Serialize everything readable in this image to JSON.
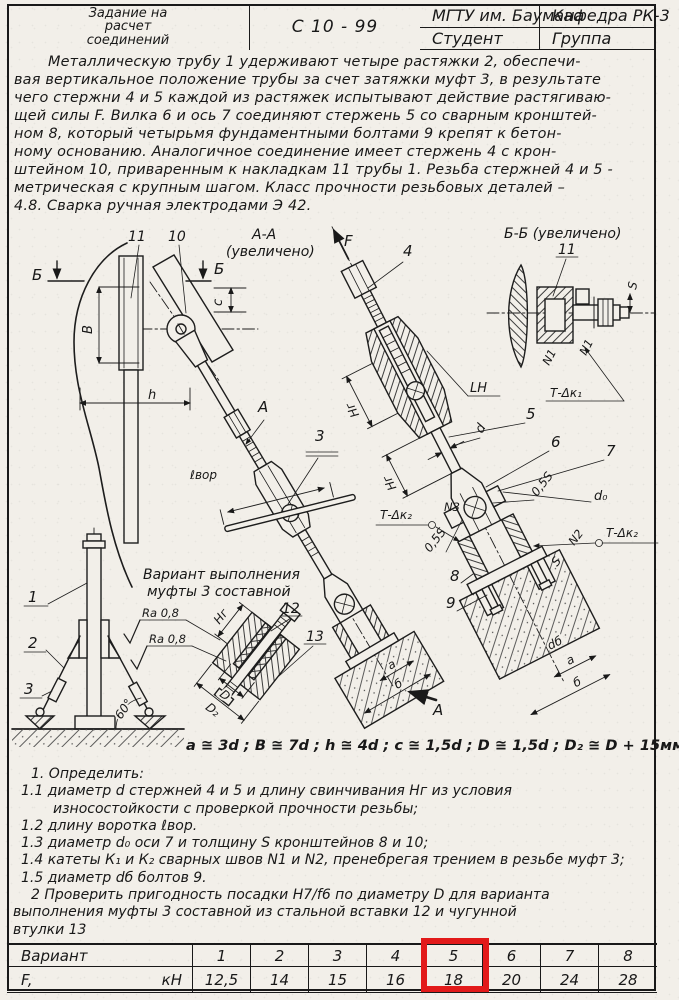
{
  "header": {
    "org": "МГТУ им. Баумана",
    "dept": "Кафедра РК-3",
    "title_line1": "Задание на",
    "title_line2": "расчет",
    "title_line3": "соединений",
    "code": "С 10 - 99",
    "student_label": "Студент",
    "group_label": "Группа"
  },
  "description": {
    "lines": [
      "Металлическую трубу 1 удерживают четыре растяжки 2, обеспечи-",
      "вая вертикальное положение трубы за счет затяжки муфт 3, в результате",
      "чего стержни 4 и 5 каждой из растяжек испытывают действие растягиваю-",
      "щей силы F. Вилка 6 и ось 7 соединяют стержень 5 со сварным кронштей-",
      "ном 8, который четырьмя фундаментными болтами 9 крепят к бетон-",
      "ному основанию. Аналогичное соединение имеет стержень 4 с крон-",
      "штейном 10, приваренным к накладкам 11 трубы 1. Резьба стержней 4 и 5 -",
      "метрическая с крупным шагом. Класс прочности резьбовых деталей –",
      "4.8. Сварка ручная электродами Э 42."
    ]
  },
  "views": {
    "aa_title_1": "А-А",
    "aa_title_2": "(увеличено)",
    "bb_title": "Б-Б (увеличено)",
    "variant_note_1": "Вариант выполнения",
    "variant_note_2": "муфты 3 составной",
    "ra_top": "Ra 0,8",
    "ra_bottom": "Ra 0,8"
  },
  "labels": {
    "f": "F",
    "p1": "1",
    "p2": "2",
    "p3": "3",
    "p3b": "3",
    "p4": "4",
    "p5": "5",
    "p6": "6",
    "p7": "7",
    "p8": "8",
    "p9": "9",
    "p10": "10",
    "p11": "11",
    "p11b": "11",
    "p12": "12",
    "p13": "13",
    "b_left": "Б",
    "b_right": "Б",
    "a_view": "А",
    "a_section": "А",
    "dim_B": "В",
    "dim_h": "h",
    "dim_c": "c",
    "dim_lvor": "ℓвор",
    "hg1": "Нг",
    "hg2": "Нг",
    "hg3": "Нг",
    "dim_d": "d",
    "dim_d0": "d₀",
    "dim_db": "dб",
    "s05a": "0,5S",
    "s05b": "0,5S",
    "dim_S": "S",
    "dim_S2": "S",
    "dim_D": "D",
    "dim_D2": "D₂",
    "a1": "a",
    "b1": "б",
    "a2": "a",
    "b2": "б",
    "lh": "LH",
    "deg60": "60°",
    "n1a": "N1",
    "n1b": "N1",
    "n2": "N2",
    "n3": "N3",
    "tk1": "Т-Δк₁",
    "tk2a": "Т-Δк₂",
    "tk2b": "Т-Δк₂"
  },
  "formula": "a ≅ 3d ;   В ≅ 7d ;   h ≅ 4d ;   c ≅ 1,5d ;   D ≅ 1,5d ;   D₂ ≅ D + 15мм.",
  "tasks": {
    "lines": [
      "1. Определить:",
      "1.1 диаметр d стержней 4 и 5 и длину свинчивания Нг из условия",
      "износостойкости с проверкой прочности резьбы;",
      "1.2 длину воротка ℓвор.",
      "1.3 диаметр d₀ оси 7 и толщину S кронштейнов 8 и 10;",
      "1.4 катеты К₁ и К₂ сварных швов N1 и N2, пренебрегая трением в резьбе муфт 3;",
      "1.5 диаметр dб болтов 9.",
      "2 Проверить пригодность посадки Н7/f6 по диаметру D для варианта",
      "выполнения муфты 3 составной из стальной вставки 12 и чугунной",
      "втулки 13"
    ]
  },
  "table": {
    "variant_label": "Вариант",
    "force_label": "F,",
    "force_unit": "кН",
    "variants": [
      "1",
      "2",
      "3",
      "4",
      "5",
      "6",
      "7",
      "8"
    ],
    "forces": [
      "12,5",
      "14",
      "15",
      "16",
      "18",
      "20",
      "24",
      "28"
    ],
    "highlighted_variant": "5"
  },
  "colors": {
    "highlight": "#e21a1a",
    "ink": "#191919",
    "paper": "#f2efe9"
  }
}
